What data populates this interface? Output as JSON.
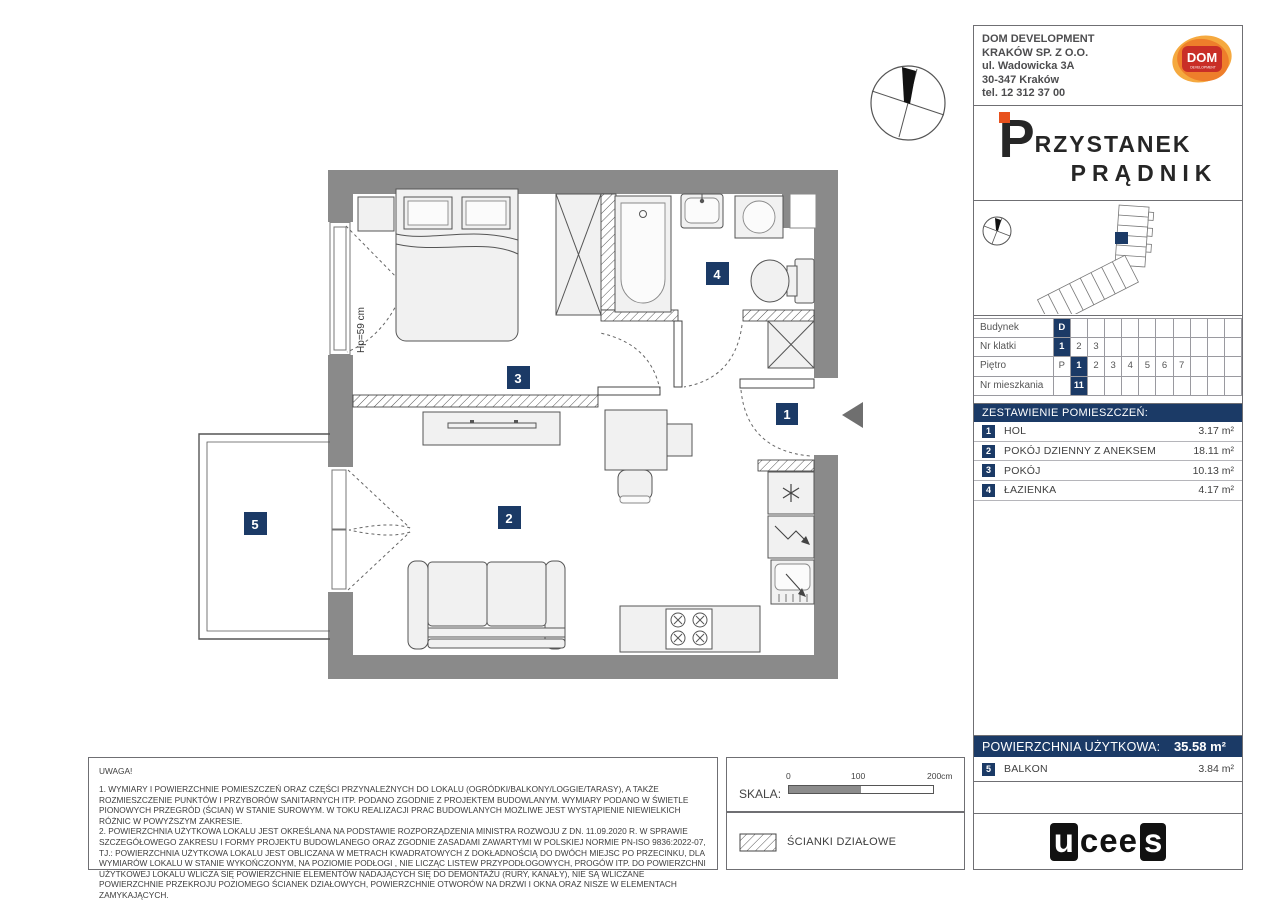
{
  "header": {
    "company": {
      "lines": [
        "DOM DEVELOPMENT",
        "KRAKÓW SP. Z O.O.",
        "ul. Wadowicka 3A",
        "30-347 Kraków",
        "tel. 12 312 37 00"
      ]
    },
    "dom_logo": {
      "label": "DOM",
      "sub": "DEVELOPMENT"
    },
    "project": {
      "initial": "P",
      "name_rest": "RZYSTANEK",
      "line2": "PRĄDNIK"
    }
  },
  "unit_table": {
    "rows": [
      {
        "label": "Budynek",
        "cells": [
          "D",
          "",
          "",
          "",
          "",
          "",
          "",
          "",
          "",
          "",
          ""
        ],
        "highlight": 0
      },
      {
        "label": "Nr klatki",
        "cells": [
          "1",
          "2",
          "3",
          "",
          "",
          "",
          "",
          "",
          "",
          "",
          ""
        ],
        "highlight": 0
      },
      {
        "label": "Piętro",
        "cells": [
          "P",
          "1",
          "2",
          "3",
          "4",
          "5",
          "6",
          "7",
          "",
          "",
          ""
        ],
        "highlight": 1
      },
      {
        "label": "Nr mieszkania",
        "cells": [
          "",
          "11",
          "",
          "",
          "",
          "",
          "",
          "",
          "",
          "",
          ""
        ],
        "highlight": 1
      }
    ]
  },
  "rooms": {
    "title": "ZESTAWIENIE POMIESZCZEŃ:",
    "items": [
      {
        "num": "1",
        "name": "HOL",
        "area": "3.17 m²"
      },
      {
        "num": "2",
        "name": "POKÓJ DZIENNY Z ANEKSEM",
        "area": "18.11 m²"
      },
      {
        "num": "3",
        "name": "POKÓJ",
        "area": "10.13 m²"
      },
      {
        "num": "4",
        "name": "ŁAZIENKA",
        "area": "4.17 m²"
      }
    ]
  },
  "summary": {
    "label": "POWIERZCHNIA UŻYTKOWA:",
    "value": "35.58 m²",
    "balcony": {
      "num": "5",
      "name": "BALKON",
      "area": "3.84 m²"
    }
  },
  "notes": {
    "title": "UWAGA!",
    "paragraphs": [
      "1. WYMIARY I POWIERZCHNIE POMIESZCZEŃ ORAZ CZĘŚCI PRZYNALEŻNYCH DO LOKALU (OGRÓDKI/BALKONY/LOGGIE/TARASY), A TAKŻE ROZMIESZCZENIE PUNKTÓW I PRZYBORÓW SANITARNYCH ITP. PODANO ZGODNIE Z PROJEKTEM BUDOWLANYM. WYMIARY PODANO W ŚWIETLE PIONOWYCH PRZEGRÓD (ŚCIAN) W STANIE SUROWYM. W TOKU REALIZACJI PRAC BUDOWLANYCH MOŻLIWE JEST WYSTĄPIENIE NIEWIELKICH RÓŻNIC W POWYŻSZYM ZAKRESIE.",
      "2. POWIERZCHNIA UŻYTKOWA LOKALU JEST OKREŚLANA NA PODSTAWIE ROZPORZĄDZENIA MINISTRA ROZWOJU Z DN. 11.09.2020 R. W SPRAWIE SZCZEGÓŁOWEGO ZAKRESU I FORMY PROJEKTU BUDOWLANEGO ORAZ ZGODNIE ZASADAMI ZAWARTYMI W POLSKIEJ NORMIE PN-ISO 9836:2022-07, TJ.: POWIERZCHNIA UŻYTKOWA LOKALU JEST OBLICZANA W METRACH KWADRATOWYCH Z DOKŁADNOŚCIĄ DO DWÓCH MIEJSC PO PRZECINKU, DLA WYMIARÓW LOKALU W STANIE WYKOŃCZONYM, NA POZIOMIE PODŁOGI , NIE LICZĄC LISTEW PRZYPODŁOGOWYCH, PROGÓW ITP. DO POWIERZCHNI UŻYTKOWEJ LOKALU WLICZA SIĘ POWIERZCHNIE ELEMENTÓW NADAJĄCYCH SIĘ DO DEMONTAŻU (RURY, KANAŁY), NIE SĄ WLICZANE POWIERZCHNIE PRZEKROJU POZIOMEGO ŚCIANEK DZIAŁOWYCH, POWIERZCHNIE OTWORÓW NA DRZWI I OKNA ORAZ NISZE W ELEMENTACH ZAMYKAJĄCYCH.",
      "3. PRZEDSTAWIONA NA RZUCIE ARANŻACJA MA CHARAKTER PRZYKŁADOWY, UMEBLOWANIE NIE STANOWI WYPOSAŻENIA NABYWANEGO LOKALU."
    ]
  },
  "scale": {
    "label": "SKALA:",
    "t0": "0",
    "t1": "100",
    "t2": "200cm"
  },
  "legend": {
    "label": "ŚCIANKI DZIAŁOWE"
  },
  "plan": {
    "badges": [
      "1",
      "2",
      "3",
      "4",
      "5"
    ],
    "window_sill": "Hp=59 cm"
  },
  "footer": {
    "logo_first": "u",
    "logo_mid": "cee",
    "logo_last": "s"
  },
  "colors": {
    "navy": "#1b3a66",
    "wall_gray": "#8a8a8a",
    "accent_orange": "#e8511d",
    "dom_red": "#c92e27",
    "dom_orange": "#ee7e2b",
    "dom_orange_light": "#f5a93f"
  }
}
